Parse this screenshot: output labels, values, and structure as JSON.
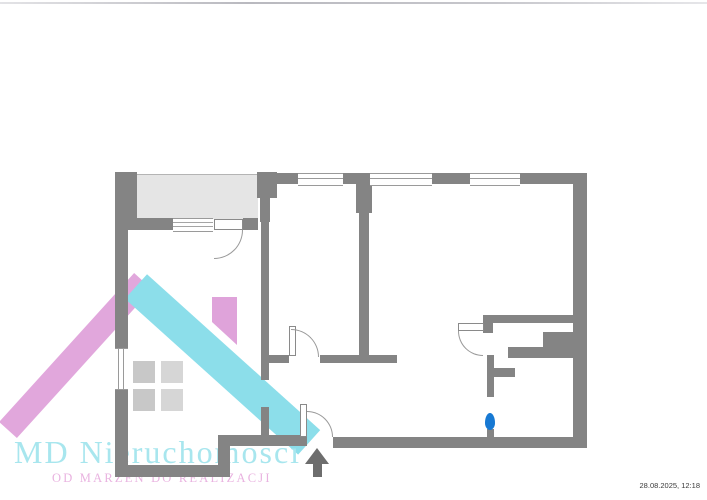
{
  "page": {
    "background": "#ffffff",
    "timestamp": "28.08.2025, 12:18"
  },
  "watermark_logo": {
    "brand": "MD Nieruchomości",
    "tagline": "OD MARZEŃ DO REALIZACJI",
    "colors": {
      "roof_left_pink": "#e1a7dc",
      "roof_right_cyan": "#8cdeea",
      "chimney_pink": "#dfa3da",
      "brand_text": "#a8e6ee",
      "tagline_text": "#e9b3e0",
      "pane_left": "#c8c8c8",
      "pane_right": "#d6d6d6"
    }
  },
  "floorplan": {
    "wall_color": "#848484",
    "balcony_fill": "#e5e5e5",
    "door_marker_color": "#1779d3",
    "entrance_arrow_color": "#6d6d6d",
    "icons": [
      "entrance-arrow-icon",
      "door-marker-pin",
      "house-logo-icon"
    ]
  }
}
